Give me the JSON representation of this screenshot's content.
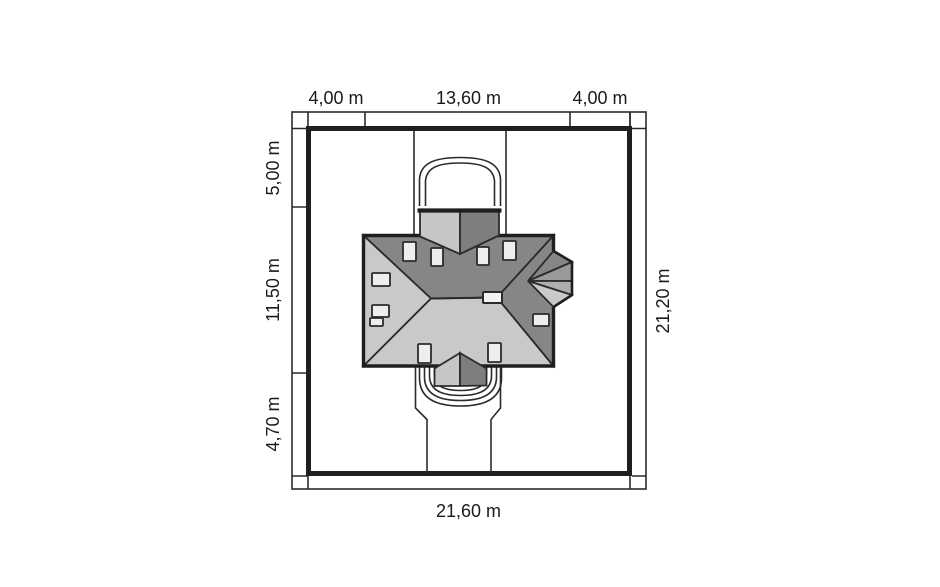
{
  "dimensions": {
    "top": [
      "4,00 m",
      "13,60 m",
      "4,00 m"
    ],
    "left": [
      "5,00 m",
      "11,50 m",
      "4,70 m"
    ],
    "right": [
      "21,20 m"
    ],
    "bottom": [
      "21,60 m"
    ]
  },
  "palette": {
    "background": "#ffffff",
    "line": "#2b2b2b",
    "outline": "#1f1f1f",
    "roof_dark": "#868686",
    "roof_light": "#c9c9c9",
    "roof_medium": "#9a9a9a",
    "roof_medium_light": "#aeaeae",
    "dormer_light": "#c6c6c6",
    "dormer_dark": "#7e7e7e",
    "skylight_fill": "#eeeeee",
    "chimney_fill": "#f2f2f2",
    "text": "#1a1a1a"
  }
}
